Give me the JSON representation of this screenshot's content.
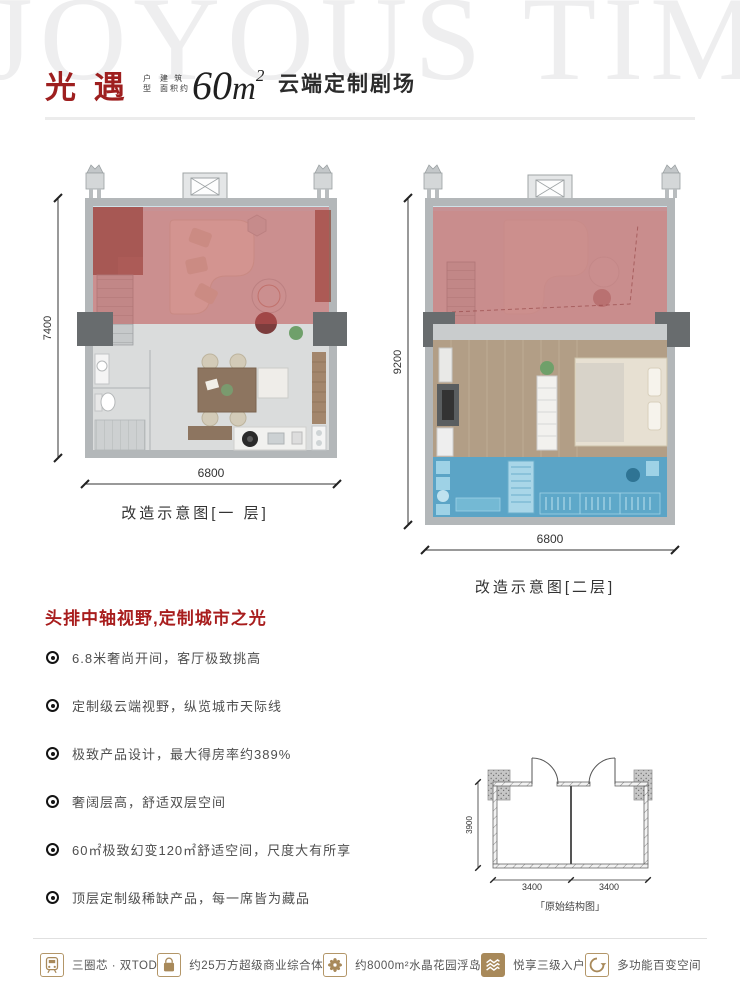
{
  "watermark": "JOYOUS TIME",
  "header": {
    "title": "光 遇",
    "type_stack": [
      "户",
      "型"
    ],
    "area_stack": [
      "建 筑",
      "面积约"
    ],
    "area_value": "60",
    "area_unit": "m",
    "area_exp": "2",
    "subtitle": "云端定制剧场"
  },
  "plan1": {
    "caption": "改造示意图[一 层]",
    "dim_height": "7400",
    "dim_width": "6800"
  },
  "plan2": {
    "caption": "改造示意图[二层]",
    "dim_height": "9200",
    "dim_width": "6800"
  },
  "features": {
    "heading": "头排中轴视野,定制城市之光",
    "items": [
      "6.8米奢尚开间，客厅极致挑高",
      "定制级云端视野，纵览城市天际线",
      "极致产品设计，最大得房率约389%",
      "奢阔层高，舒适双层空间",
      "60㎡极致幻变120㎡舒适空间，尺度大有所享",
      "顶层定制级稀缺产品，每一席皆为藏品"
    ]
  },
  "structure": {
    "caption": "「原始结构图」",
    "dim_height": "3900",
    "dim_left": "3400",
    "dim_right": "3400"
  },
  "footer": {
    "items": [
      {
        "icon": "train-icon",
        "label": "三圈芯 · 双TOD"
      },
      {
        "icon": "bag-icon",
        "label": "约25万方超级商业综合体"
      },
      {
        "icon": "flower-icon",
        "label": "约8000m²水晶花园浮岛"
      },
      {
        "icon": "stairs-icon",
        "label": "悦享三级入户"
      },
      {
        "icon": "loop-icon",
        "label": "多功能百变空间"
      }
    ]
  },
  "colors": {
    "accent_red": "#9e1f1f",
    "overlay_red": "#c05050",
    "overlay_blue": "#3f98c2",
    "gold": "#a8895a",
    "wall_gray": "#b3b7b9"
  }
}
